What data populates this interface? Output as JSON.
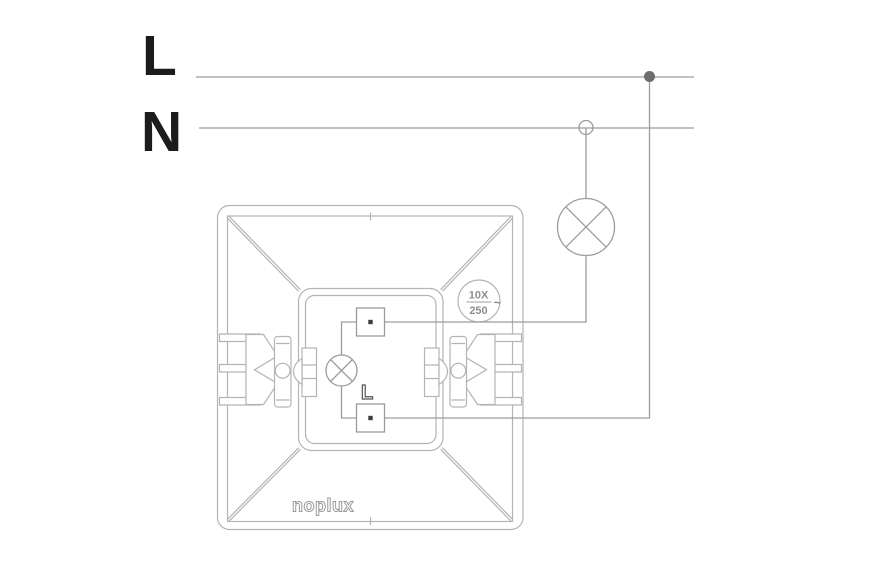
{
  "colors": {
    "background": "#ffffff",
    "circuit_line": "#9c9c9c",
    "device_line": "#b4b4b4",
    "label_text": "#1c1c1c",
    "terminal_dot": "#3c3c3c",
    "junction_fill": "#6d6d6d",
    "rating_text": "#8e8e8e",
    "brand_outline": "#9c9c9c",
    "marking_outline": "#555555"
  },
  "supply": {
    "live_label": "L",
    "neutral_label": "N"
  },
  "load": {
    "icon": "lamp-icon"
  },
  "device": {
    "brand": "noplux",
    "terminal_marking": "L",
    "indicator_icon": "indicator-lamp-icon",
    "rating": {
      "current": "10X",
      "voltage": "250",
      "ac_symbol": "~"
    }
  }
}
